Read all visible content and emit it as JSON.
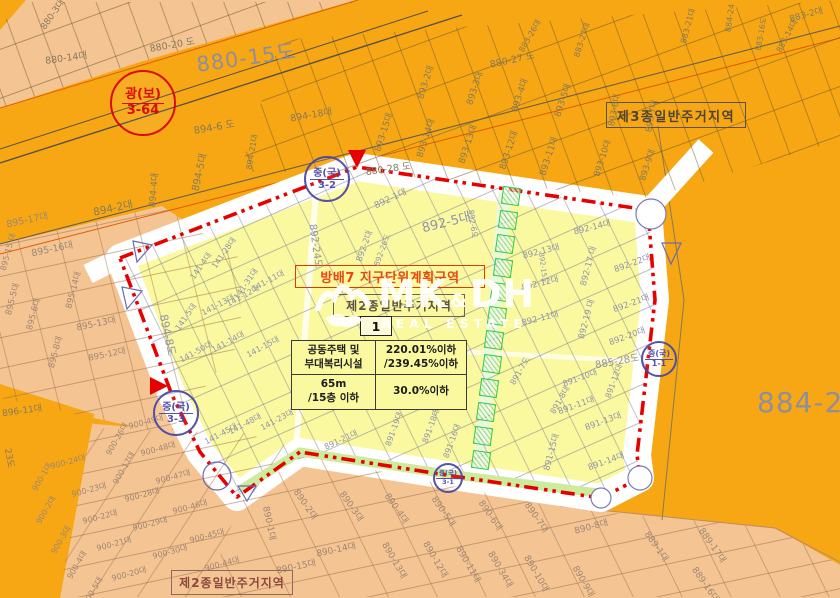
{
  "watermark": {
    "brand_main": "MK",
    "brand_amp": "&",
    "brand_sub": "DH",
    "brand_tagline": "REAL ESTATE"
  },
  "plan": {
    "title": "방배7 지구단위계획구역",
    "unit_number": "1",
    "zone_in_plan": "제2종일반주거지역"
  },
  "zones": {
    "zone_top_right": "제3종일반주거지역",
    "zone_bottom": "제2종일반주거지역",
    "big_label_road": "880-15도",
    "big_label_right": "884-2"
  },
  "info_table": {
    "rows": [
      [
        "공동주택 및\n부대복리시설",
        "220.01%이하\n/239.45%이하"
      ],
      [
        "65m\n/15층 이하",
        "30.0%이하"
      ]
    ]
  },
  "stamps": [
    {
      "x": 141,
      "y": 101,
      "r": 31,
      "top": "광(보)",
      "bottom": "3-64",
      "color": "#D80000",
      "fs": 13
    },
    {
      "x": 325,
      "y": 177,
      "r": 21,
      "top": "중(국)",
      "bottom": "3-2",
      "color": "#4646A6",
      "fs": 10
    },
    {
      "x": 174,
      "y": 411,
      "r": 21,
      "top": "중(국)",
      "bottom": "3-3",
      "color": "#4646A6",
      "fs": 10
    },
    {
      "x": 657,
      "y": 357,
      "r": 16,
      "top": "중(국)",
      "bottom": "1-1",
      "color": "#4646A6",
      "fs": 8
    },
    {
      "x": 446,
      "y": 476,
      "r": 13,
      "top": "중(국)",
      "bottom": "3-1",
      "color": "#4646A6",
      "fs": 6.5
    }
  ],
  "green_squares": [
    [
      511,
      196
    ],
    [
      508,
      220
    ],
    [
      505,
      244
    ],
    [
      503,
      268
    ],
    [
      500,
      292
    ],
    [
      497,
      316
    ],
    [
      494,
      340
    ],
    [
      492,
      364
    ],
    [
      489,
      388
    ],
    [
      486,
      412
    ],
    [
      483,
      436
    ],
    [
      481,
      460
    ]
  ],
  "colors": {
    "orange": "#F6A713",
    "salmon": "#F5C493",
    "yellow": "#FBF99F",
    "boundary_red": "#E60000",
    "stamp_blue": "#4646A6",
    "stamp_red": "#D80000",
    "green_strip": "#CDEB9C",
    "square_green": "#2ECC44"
  },
  "parcel_labels": [
    {
      "t": "880-3대",
      "x": 52,
      "y": 14,
      "r": -55,
      "s": 9,
      "c": "or"
    },
    {
      "t": "880-14대",
      "x": 66,
      "y": 57,
      "r": -8,
      "s": 9.5,
      "c": "or"
    },
    {
      "t": "880-20 도",
      "x": 172,
      "y": 44,
      "r": -10,
      "s": 9.5,
      "c": "or"
    },
    {
      "t": "894-6 도",
      "x": 214,
      "y": 126,
      "r": -10,
      "s": 10,
      "c": "or"
    },
    {
      "t": "894-5대",
      "x": 198,
      "y": 172,
      "r": -78,
      "s": 10,
      "c": "or"
    },
    {
      "t": "894-21대",
      "x": 252,
      "y": 152,
      "r": -80,
      "s": 8,
      "c": "or"
    },
    {
      "t": "894-2대",
      "x": 113,
      "y": 208,
      "r": -12,
      "s": 10.5,
      "c": "or"
    },
    {
      "t": "894-4대",
      "x": 153,
      "y": 190,
      "r": -85,
      "s": 9,
      "c": "or"
    },
    {
      "t": "894-18대",
      "x": 311,
      "y": 114,
      "r": -10,
      "s": 9.5,
      "c": "or"
    },
    {
      "t": "880-27 도",
      "x": 512,
      "y": 59,
      "r": -12,
      "s": 9.5,
      "c": "or"
    },
    {
      "t": "893-2대",
      "x": 425,
      "y": 82,
      "r": -72,
      "s": 9,
      "c": "or"
    },
    {
      "t": "893-3대",
      "x": 474,
      "y": 88,
      "r": -72,
      "s": 9,
      "c": "or"
    },
    {
      "t": "893-4대",
      "x": 519,
      "y": 95,
      "r": -72,
      "s": 9,
      "c": "or"
    },
    {
      "t": "893-5대",
      "x": 562,
      "y": 100,
      "r": -72,
      "s": 9,
      "c": "or"
    },
    {
      "t": "893-6대",
      "x": 614,
      "y": 110,
      "r": -80,
      "s": 8.5,
      "c": "or"
    },
    {
      "t": "893-7대",
      "x": 651,
      "y": 116,
      "r": -80,
      "s": 8.5,
      "c": "or"
    },
    {
      "t": "893-15대",
      "x": 383,
      "y": 132,
      "r": -72,
      "s": 9,
      "c": "or"
    },
    {
      "t": "893-14대",
      "x": 425,
      "y": 138,
      "r": -72,
      "s": 9,
      "c": "or"
    },
    {
      "t": "893-13대",
      "x": 467,
      "y": 144,
      "r": -72,
      "s": 9,
      "c": "or"
    },
    {
      "t": "893-12대",
      "x": 508,
      "y": 150,
      "r": -72,
      "s": 9,
      "c": "or"
    },
    {
      "t": "893-11대",
      "x": 548,
      "y": 156,
      "r": -72,
      "s": 9,
      "c": "or"
    },
    {
      "t": "893-10대",
      "x": 602,
      "y": 158,
      "r": -72,
      "s": 8.5,
      "c": "or"
    },
    {
      "t": "893-9대",
      "x": 647,
      "y": 165,
      "r": -72,
      "s": 8.5,
      "c": "or"
    },
    {
      "t": "883-2대",
      "x": 806,
      "y": 14,
      "r": -15,
      "s": 9,
      "c": "or"
    },
    {
      "t": "883-27대",
      "x": 582,
      "y": 40,
      "r": -72,
      "s": 8,
      "c": "or"
    },
    {
      "t": "883-26대",
      "x": 530,
      "y": 36,
      "r": -60,
      "s": 8,
      "c": "or"
    },
    {
      "t": "883-21대",
      "x": 688,
      "y": 26,
      "r": -75,
      "s": 8,
      "c": "or"
    },
    {
      "t": "884-24",
      "x": 730,
      "y": 18,
      "r": -82,
      "s": 8,
      "c": "or"
    },
    {
      "t": "883-16도",
      "x": 761,
      "y": 34,
      "r": -80,
      "s": 7.5,
      "c": "or"
    },
    {
      "t": "883-14대",
      "x": 787,
      "y": 36,
      "r": -62,
      "s": 8,
      "c": "or"
    },
    {
      "t": "880-28 도",
      "x": 388,
      "y": 168,
      "r": -8,
      "s": 9.5,
      "c": "or"
    },
    {
      "t": "896-11대",
      "x": 22,
      "y": 410,
      "r": -8,
      "s": 9,
      "c": "or"
    },
    {
      "t": "23도",
      "x": 10,
      "y": 458,
      "r": 80,
      "s": 9,
      "c": "or"
    },
    {
      "t": "895-17대",
      "x": 27,
      "y": 219,
      "r": -12,
      "s": 9.5,
      "c": "sa"
    },
    {
      "t": "895-16대",
      "x": 52,
      "y": 248,
      "r": -12,
      "s": 9.5,
      "c": "sa"
    },
    {
      "t": "895-15 대",
      "x": 8,
      "y": 252,
      "r": -75,
      "s": 8,
      "c": "sa"
    },
    {
      "t": "895-5대",
      "x": 12,
      "y": 299,
      "r": -75,
      "s": 8.5,
      "c": "sa"
    },
    {
      "t": "895-6대",
      "x": 33,
      "y": 314,
      "r": -75,
      "s": 8.5,
      "c": "sa"
    },
    {
      "t": "895-14대",
      "x": 73,
      "y": 290,
      "r": -75,
      "s": 8.5,
      "c": "sa"
    },
    {
      "t": "895-13대",
      "x": 96,
      "y": 323,
      "r": -12,
      "s": 9,
      "c": "sa"
    },
    {
      "t": "895-8대",
      "x": 55,
      "y": 352,
      "r": -75,
      "s": 8.5,
      "c": "sa"
    },
    {
      "t": "895-12대",
      "x": 107,
      "y": 354,
      "r": -12,
      "s": 8.5,
      "c": "sa"
    },
    {
      "t": "894-8도",
      "x": 168,
      "y": 335,
      "r": 78,
      "s": 11,
      "c": "ye"
    },
    {
      "t": "892-1대",
      "x": 390,
      "y": 198,
      "r": -25,
      "s": 9,
      "c": "ye"
    },
    {
      "t": "892-5대",
      "x": 446,
      "y": 221,
      "r": -14,
      "s": 13,
      "c": "ye"
    },
    {
      "t": "892-24도",
      "x": 317,
      "y": 246,
      "r": 82,
      "s": 10,
      "c": "ye"
    },
    {
      "t": "892-2대",
      "x": 364,
      "y": 246,
      "r": -70,
      "s": 8.5,
      "c": "ye"
    },
    {
      "t": "892-26도",
      "x": 382,
      "y": 250,
      "r": -70,
      "s": 7.5,
      "c": "ye"
    },
    {
      "t": "892-6도",
      "x": 473,
      "y": 224,
      "r": 82,
      "s": 7.5,
      "c": "ye"
    },
    {
      "t": "892-14대",
      "x": 592,
      "y": 227,
      "r": -14,
      "s": 8.5,
      "c": "ye"
    },
    {
      "t": "892-13대",
      "x": 541,
      "y": 251,
      "r": -14,
      "s": 8.5,
      "c": "ye"
    },
    {
      "t": "892-15도",
      "x": 543,
      "y": 268,
      "r": 82,
      "s": 7,
      "c": "ye"
    },
    {
      "t": "892-12대",
      "x": 540,
      "y": 283,
      "r": -14,
      "s": 8.5,
      "c": "ye"
    },
    {
      "t": "892-11대",
      "x": 540,
      "y": 318,
      "r": -14,
      "s": 8.5,
      "c": "ye"
    },
    {
      "t": "892-17 대",
      "x": 588,
      "y": 266,
      "r": -75,
      "s": 8.5,
      "c": "ye"
    },
    {
      "t": "892-22대",
      "x": 632,
      "y": 263,
      "r": -20,
      "s": 8.5,
      "c": "ye"
    },
    {
      "t": "892-21대",
      "x": 631,
      "y": 303,
      "r": -20,
      "s": 8.5,
      "c": "ye"
    },
    {
      "t": "892-19 대",
      "x": 586,
      "y": 319,
      "r": -75,
      "s": 8.5,
      "c": "ye"
    },
    {
      "t": "892-20대",
      "x": 627,
      "y": 336,
      "r": -20,
      "s": 8.5,
      "c": "ye"
    },
    {
      "t": "885-28도",
      "x": 617,
      "y": 360,
      "r": -10,
      "s": 10,
      "c": "ye"
    },
    {
      "t": "891-10대",
      "x": 580,
      "y": 378,
      "r": -20,
      "s": 8,
      "c": "ye"
    },
    {
      "t": "891-12대",
      "x": 614,
      "y": 381,
      "r": -70,
      "s": 8,
      "c": "ye"
    },
    {
      "t": "141-28대",
      "x": 224,
      "y": 253,
      "r": -55,
      "s": 8,
      "c": "ye"
    },
    {
      "t": "141-4대",
      "x": 201,
      "y": 266,
      "r": -55,
      "s": 8,
      "c": "ye"
    },
    {
      "t": "141-31대",
      "x": 246,
      "y": 284,
      "r": -55,
      "s": 8,
      "c": "ye"
    },
    {
      "t": "141-11대",
      "x": 268,
      "y": 281,
      "r": -28,
      "s": 8,
      "c": "ye"
    },
    {
      "t": "141-12대",
      "x": 243,
      "y": 296,
      "r": -28,
      "s": 8,
      "c": "ye"
    },
    {
      "t": "141-13대",
      "x": 218,
      "y": 305,
      "r": -28,
      "s": 8,
      "c": "ye"
    },
    {
      "t": "141-5대",
      "x": 186,
      "y": 317,
      "r": -55,
      "s": 8,
      "c": "ye"
    },
    {
      "t": "141-50대",
      "x": 196,
      "y": 352,
      "r": -28,
      "s": 8,
      "c": "ye"
    },
    {
      "t": "141-14대",
      "x": 228,
      "y": 342,
      "r": -28,
      "s": 8,
      "c": "ye"
    },
    {
      "t": "141-15대",
      "x": 263,
      "y": 347,
      "r": -28,
      "s": 8,
      "c": "ye"
    },
    {
      "t": "141-45대",
      "x": 221,
      "y": 434,
      "r": -28,
      "s": 8,
      "c": "ye"
    },
    {
      "t": "141-48대",
      "x": 245,
      "y": 424,
      "r": -28,
      "s": 8,
      "c": "ye"
    },
    {
      "t": "141-23대",
      "x": 277,
      "y": 420,
      "r": -28,
      "s": 8,
      "c": "ye"
    },
    {
      "t": "891-21대",
      "x": 341,
      "y": 440,
      "r": -25,
      "s": 8,
      "c": "ye"
    },
    {
      "t": "891-19대",
      "x": 394,
      "y": 429,
      "r": -70,
      "s": 8,
      "c": "ye"
    },
    {
      "t": "891-18대",
      "x": 431,
      "y": 426,
      "r": -70,
      "s": 8,
      "c": "ye"
    },
    {
      "t": "891-16대",
      "x": 452,
      "y": 441,
      "r": -70,
      "s": 8,
      "c": "ye"
    },
    {
      "t": "891-15대",
      "x": 551,
      "y": 452,
      "r": -75,
      "s": 8.5,
      "c": "ye"
    },
    {
      "t": "891-7도",
      "x": 520,
      "y": 371,
      "r": -60,
      "s": 8,
      "c": "ye"
    },
    {
      "t": "891-8대",
      "x": 560,
      "y": 400,
      "r": -60,
      "s": 8,
      "c": "ye"
    },
    {
      "t": "891-13대",
      "x": 603,
      "y": 421,
      "r": -20,
      "s": 8.5,
      "c": "ye"
    },
    {
      "t": "891-11대",
      "x": 576,
      "y": 405,
      "r": -20,
      "s": 8.5,
      "c": "ye"
    },
    {
      "t": "891-14대",
      "x": 606,
      "y": 461,
      "r": -20,
      "s": 8.5,
      "c": "ye"
    },
    {
      "t": "890-1대",
      "x": 270,
      "y": 523,
      "r": 78,
      "s": 9,
      "c": "sa"
    },
    {
      "t": "890-2대",
      "x": 306,
      "y": 504,
      "r": 55,
      "s": 9,
      "c": "sa"
    },
    {
      "t": "890-3대",
      "x": 352,
      "y": 506,
      "r": 55,
      "s": 9,
      "c": "sa"
    },
    {
      "t": "890-4대",
      "x": 397,
      "y": 508,
      "r": 55,
      "s": 9,
      "c": "sa"
    },
    {
      "t": "890-5대",
      "x": 444,
      "y": 511,
      "r": 55,
      "s": 9,
      "c": "sa"
    },
    {
      "t": "890-6대",
      "x": 491,
      "y": 515,
      "r": 55,
      "s": 9,
      "c": "sa"
    },
    {
      "t": "890-7대",
      "x": 537,
      "y": 517,
      "r": 55,
      "s": 9,
      "c": "sa"
    },
    {
      "t": "890-14대",
      "x": 336,
      "y": 549,
      "r": -12,
      "s": 9,
      "c": "sa"
    },
    {
      "t": "890-15대",
      "x": 296,
      "y": 566,
      "r": -12,
      "s": 9,
      "c": "sa"
    },
    {
      "t": "890-13대",
      "x": 395,
      "y": 560,
      "r": 60,
      "s": 9,
      "c": "sa"
    },
    {
      "t": "890-12대",
      "x": 436,
      "y": 559,
      "r": 60,
      "s": 9,
      "c": "sa"
    },
    {
      "t": "890-11대",
      "x": 469,
      "y": 564,
      "r": 60,
      "s": 9,
      "c": "sa"
    },
    {
      "t": "890-34대",
      "x": 501,
      "y": 569,
      "r": 60,
      "s": 9,
      "c": "sa"
    },
    {
      "t": "890-10대",
      "x": 537,
      "y": 573,
      "r": 60,
      "s": 9,
      "c": "sa"
    },
    {
      "t": "890-8대",
      "x": 591,
      "y": 526,
      "r": -15,
      "s": 9,
      "c": "sa"
    },
    {
      "t": "890-9대",
      "x": 584,
      "y": 581,
      "r": 60,
      "s": 9,
      "c": "sa"
    },
    {
      "t": "889-1대",
      "x": 657,
      "y": 546,
      "r": 55,
      "s": 9,
      "c": "sa"
    },
    {
      "t": "889-17대",
      "x": 713,
      "y": 545,
      "r": 55,
      "s": 9,
      "c": "sa"
    },
    {
      "t": "889-16대",
      "x": 706,
      "y": 584,
      "r": 55,
      "s": 9,
      "c": "sa"
    },
    {
      "t": "900-49대",
      "x": 146,
      "y": 422,
      "r": -15,
      "s": 8,
      "c": "sa"
    },
    {
      "t": "900-26대",
      "x": 117,
      "y": 439,
      "r": -60,
      "s": 8,
      "c": "sa"
    },
    {
      "t": "900-24대",
      "x": 68,
      "y": 462,
      "r": -15,
      "s": 8,
      "c": "sa"
    },
    {
      "t": "900-17대",
      "x": 124,
      "y": 468,
      "r": -60,
      "s": 8,
      "c": "sa"
    },
    {
      "t": "900-48대",
      "x": 158,
      "y": 449,
      "r": -15,
      "s": 8,
      "c": "sa"
    },
    {
      "t": "900-1대",
      "x": 42,
      "y": 477,
      "r": -60,
      "s": 8,
      "c": "sa"
    },
    {
      "t": "900-23대",
      "x": 89,
      "y": 490,
      "r": -15,
      "s": 8,
      "c": "sa"
    },
    {
      "t": "900-47대",
      "x": 173,
      "y": 477,
      "r": -15,
      "s": 8,
      "c": "sa"
    },
    {
      "t": "900-28대",
      "x": 142,
      "y": 495,
      "r": -15,
      "s": 8,
      "c": "sa"
    },
    {
      "t": "900-2대",
      "x": 46,
      "y": 510,
      "r": -60,
      "s": 8,
      "c": "sa"
    },
    {
      "t": "900-22대",
      "x": 100,
      "y": 517,
      "r": -15,
      "s": 8,
      "c": "sa"
    },
    {
      "t": "900-46대",
      "x": 190,
      "y": 507,
      "r": -15,
      "s": 8,
      "c": "sa"
    },
    {
      "t": "900-29대",
      "x": 150,
      "y": 524,
      "r": -15,
      "s": 8,
      "c": "sa"
    },
    {
      "t": "900-3대",
      "x": 61,
      "y": 540,
      "r": -60,
      "s": 8,
      "c": "sa"
    },
    {
      "t": "900-21대",
      "x": 114,
      "y": 544,
      "r": -15,
      "s": 8,
      "c": "sa"
    },
    {
      "t": "900-45대",
      "x": 207,
      "y": 536,
      "r": -15,
      "s": 8,
      "c": "sa"
    },
    {
      "t": "900-30대",
      "x": 170,
      "y": 552,
      "r": -15,
      "s": 8,
      "c": "sa"
    },
    {
      "t": "900-4대",
      "x": 77,
      "y": 565,
      "r": -60,
      "s": 8,
      "c": "sa"
    },
    {
      "t": "900-20대",
      "x": 129,
      "y": 574,
      "r": -15,
      "s": 8,
      "c": "sa"
    },
    {
      "t": "900-44대",
      "x": 222,
      "y": 564,
      "r": -15,
      "s": 8,
      "c": "sa"
    },
    {
      "t": "900-5대",
      "x": 93,
      "y": 591,
      "r": -60,
      "s": 8,
      "c": "sa"
    }
  ]
}
